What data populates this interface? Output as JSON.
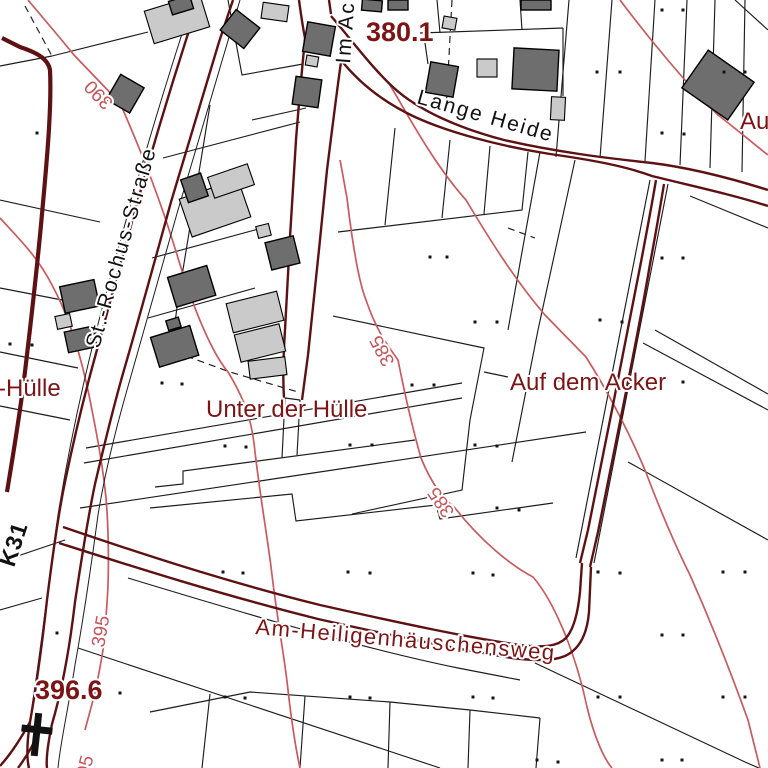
{
  "map": {
    "street_labels": [
      {
        "id": "st-rochus-strasse",
        "text": "St.-Rochus-Straße"
      },
      {
        "id": "im-acker-partial",
        "text": "Im Ac"
      },
      {
        "id": "lange-heide",
        "text": "Lange Heide"
      },
      {
        "id": "k31",
        "text": "K31"
      }
    ],
    "area_labels": [
      {
        "id": "r-huelle-partial",
        "text": "r-Hülle"
      },
      {
        "id": "unter-der-huelle",
        "text": "Unter der Hülle"
      },
      {
        "id": "auf-dem-acker",
        "text": "Auf dem Acker"
      },
      {
        "id": "am-heiligenhaeuschensweg",
        "text": "Am-Heiligenhäuschensweg"
      },
      {
        "id": "au-partial",
        "text": "Au"
      }
    ],
    "spot_elevations": [
      {
        "id": "spot-380-1",
        "text": "380.1"
      },
      {
        "id": "spot-396-6",
        "text": "396.6"
      }
    ],
    "contour_labels": [
      {
        "id": "contour-390",
        "text": "390"
      },
      {
        "id": "contour-385-a",
        "text": "385"
      },
      {
        "id": "contour-385-b",
        "text": "385"
      },
      {
        "id": "contour-395-a",
        "text": "395"
      },
      {
        "id": "contour-395-b",
        "text": "395"
      }
    ],
    "colors": {
      "road_edge": "#5e1113",
      "contour_line": "#ca5a5e",
      "label_dark_red": "#7c1416",
      "building_dark": "#6e6e6e",
      "building_light": "#cacaca",
      "parcel_line": "#1c1c1c",
      "background": "#ffffff"
    }
  }
}
